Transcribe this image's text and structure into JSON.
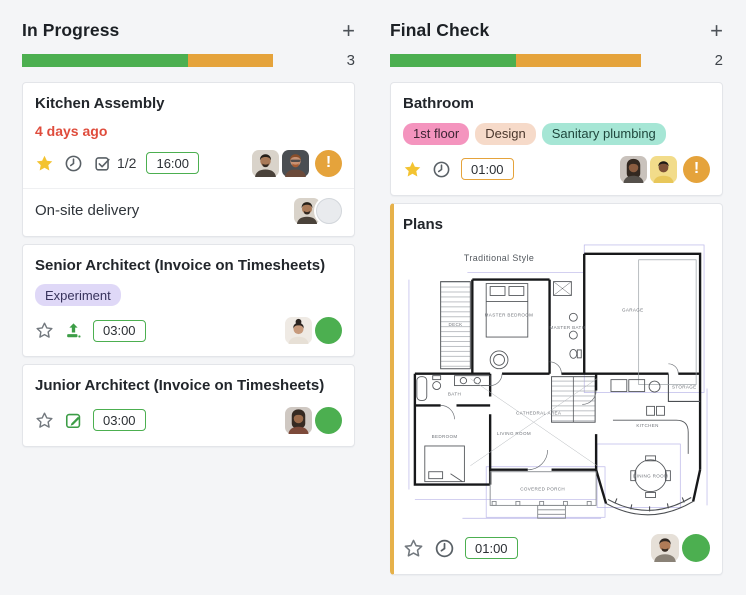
{
  "columns": {
    "in_progress": {
      "title": "In Progress",
      "add_icon": "+",
      "count": "3",
      "progress_green_pct": 66,
      "progress_orange_pct": 34
    },
    "final_check": {
      "title": "Final Check",
      "add_icon": "+",
      "count": "2",
      "progress_green_pct": 50,
      "progress_orange_pct": 50
    }
  },
  "cards": {
    "kitchen_assembly": {
      "title": "Kitchen Assembly",
      "due": "4 days ago",
      "checklist": "1/2",
      "time": "16:00",
      "alert": "!",
      "subtask": {
        "title": "On-site delivery"
      }
    },
    "senior_architect": {
      "title": "Senior Architect (Invoice on Timesheets)",
      "tags": [
        "Experiment"
      ],
      "time": "03:00"
    },
    "junior_architect": {
      "title": "Junior Architect (Invoice on Timesheets)",
      "time": "03:00"
    },
    "bathroom": {
      "title": "Bathroom",
      "tags": [
        "1st floor",
        "Design",
        "Sanitary plumbing"
      ],
      "time": "01:00",
      "alert": "!"
    },
    "plans": {
      "title": "Plans",
      "time": "01:00",
      "floorplan": {
        "style_label": "Traditional Style",
        "rooms": {
          "deck": "DECK",
          "master_bedroom": "MASTER BEDROOM",
          "master_bath": "MASTER BATH",
          "garage": "GARAGE",
          "bath": "BATH",
          "storage": "STORAGE",
          "cathedral_area": "CATHEDRAL AREA",
          "living_room": "LIVING ROOM",
          "kitchen": "KITCHEN",
          "bedroom": "BEDROOM",
          "covered_porch": "COVERED PORCH",
          "dining_room": "DINING ROOM"
        }
      }
    }
  },
  "colors": {
    "background": "#F4F5F7",
    "progress_green": "#4CAF50",
    "progress_orange": "#E5A33B",
    "due_red": "#DF4C3C",
    "star_gold": "#F3C331",
    "status_green": "#4CAF50",
    "alert_orange": "#E5A33B",
    "badge_border_green": "#4CAF50",
    "badge_border_orange": "#E5A33B",
    "tag_purple_bg": "#DFD8F7",
    "tag_pink_bg": "#F494BE",
    "tag_peach_bg": "#F6DAC9",
    "tag_teal_bg": "#A6E6D5",
    "plans_card_accent": "#E6B14A"
  }
}
